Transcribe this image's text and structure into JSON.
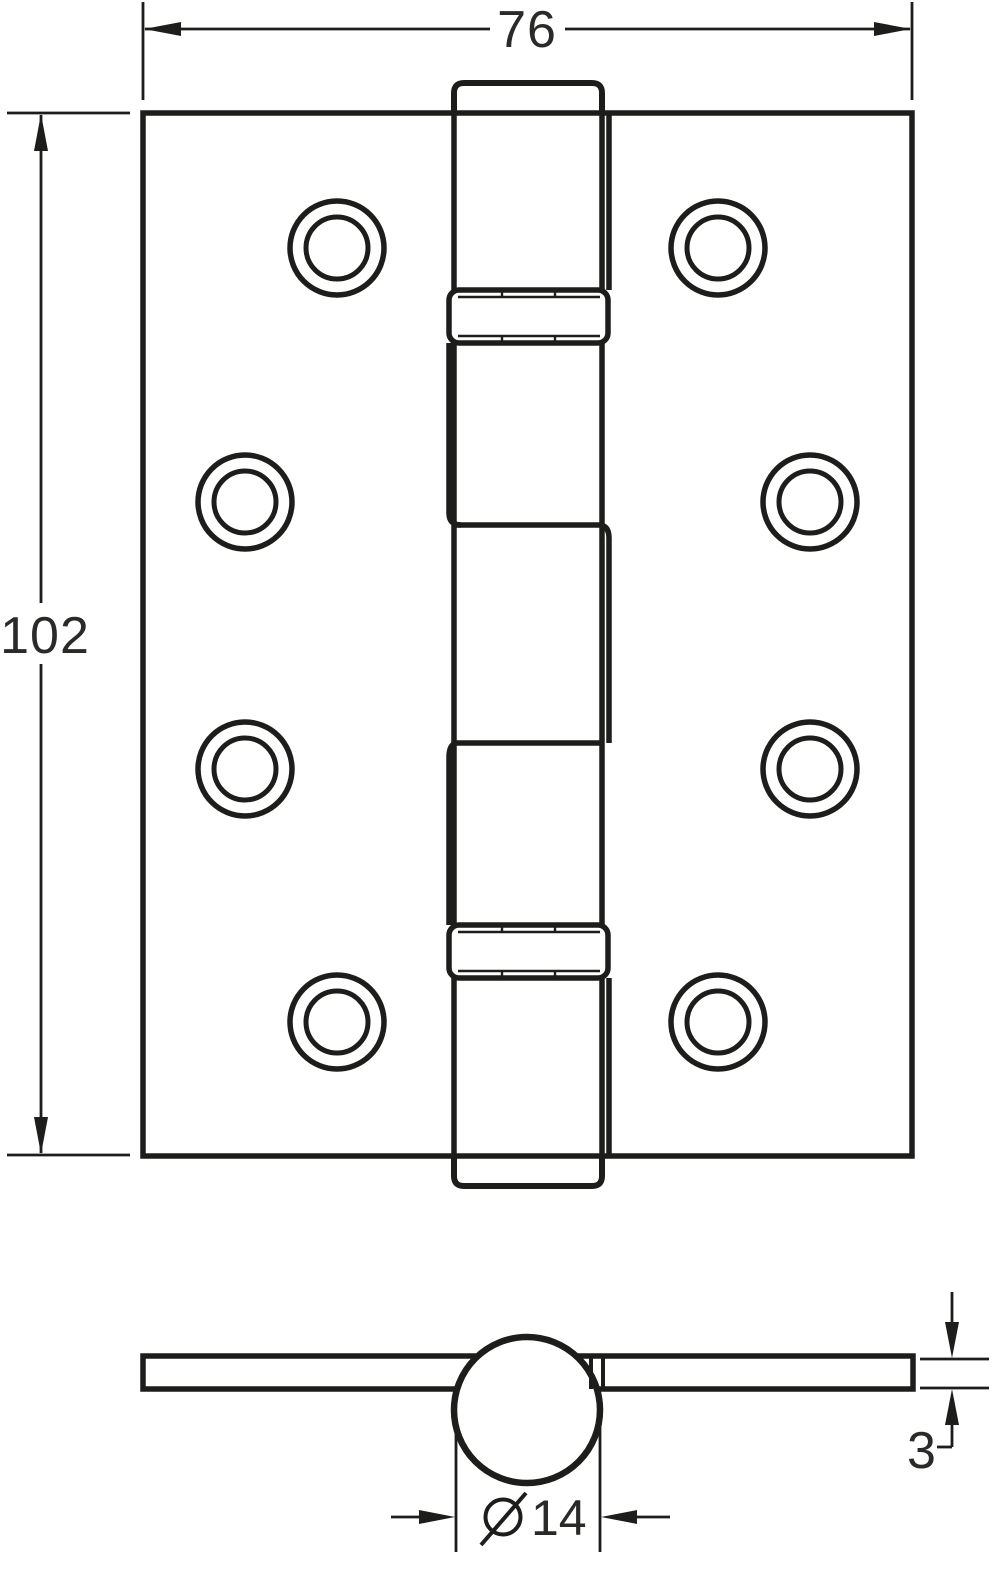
{
  "drawing": {
    "type": "technical-drawing",
    "subject": "ball-bearing butt hinge, orthographic views",
    "colors": {
      "line": "#1d1d1b",
      "background": "#ffffff",
      "text": "#2a2a28"
    },
    "views": {
      "front": {
        "screw_hole_count": 8,
        "dimensions": {
          "width": {
            "label": "76"
          },
          "height": {
            "label": "102"
          }
        }
      },
      "side": {
        "dimensions": {
          "thickness": {
            "label": "3"
          },
          "knuckle_diameter": {
            "label": "14",
            "symbol": "diameter-sign"
          }
        }
      }
    }
  }
}
